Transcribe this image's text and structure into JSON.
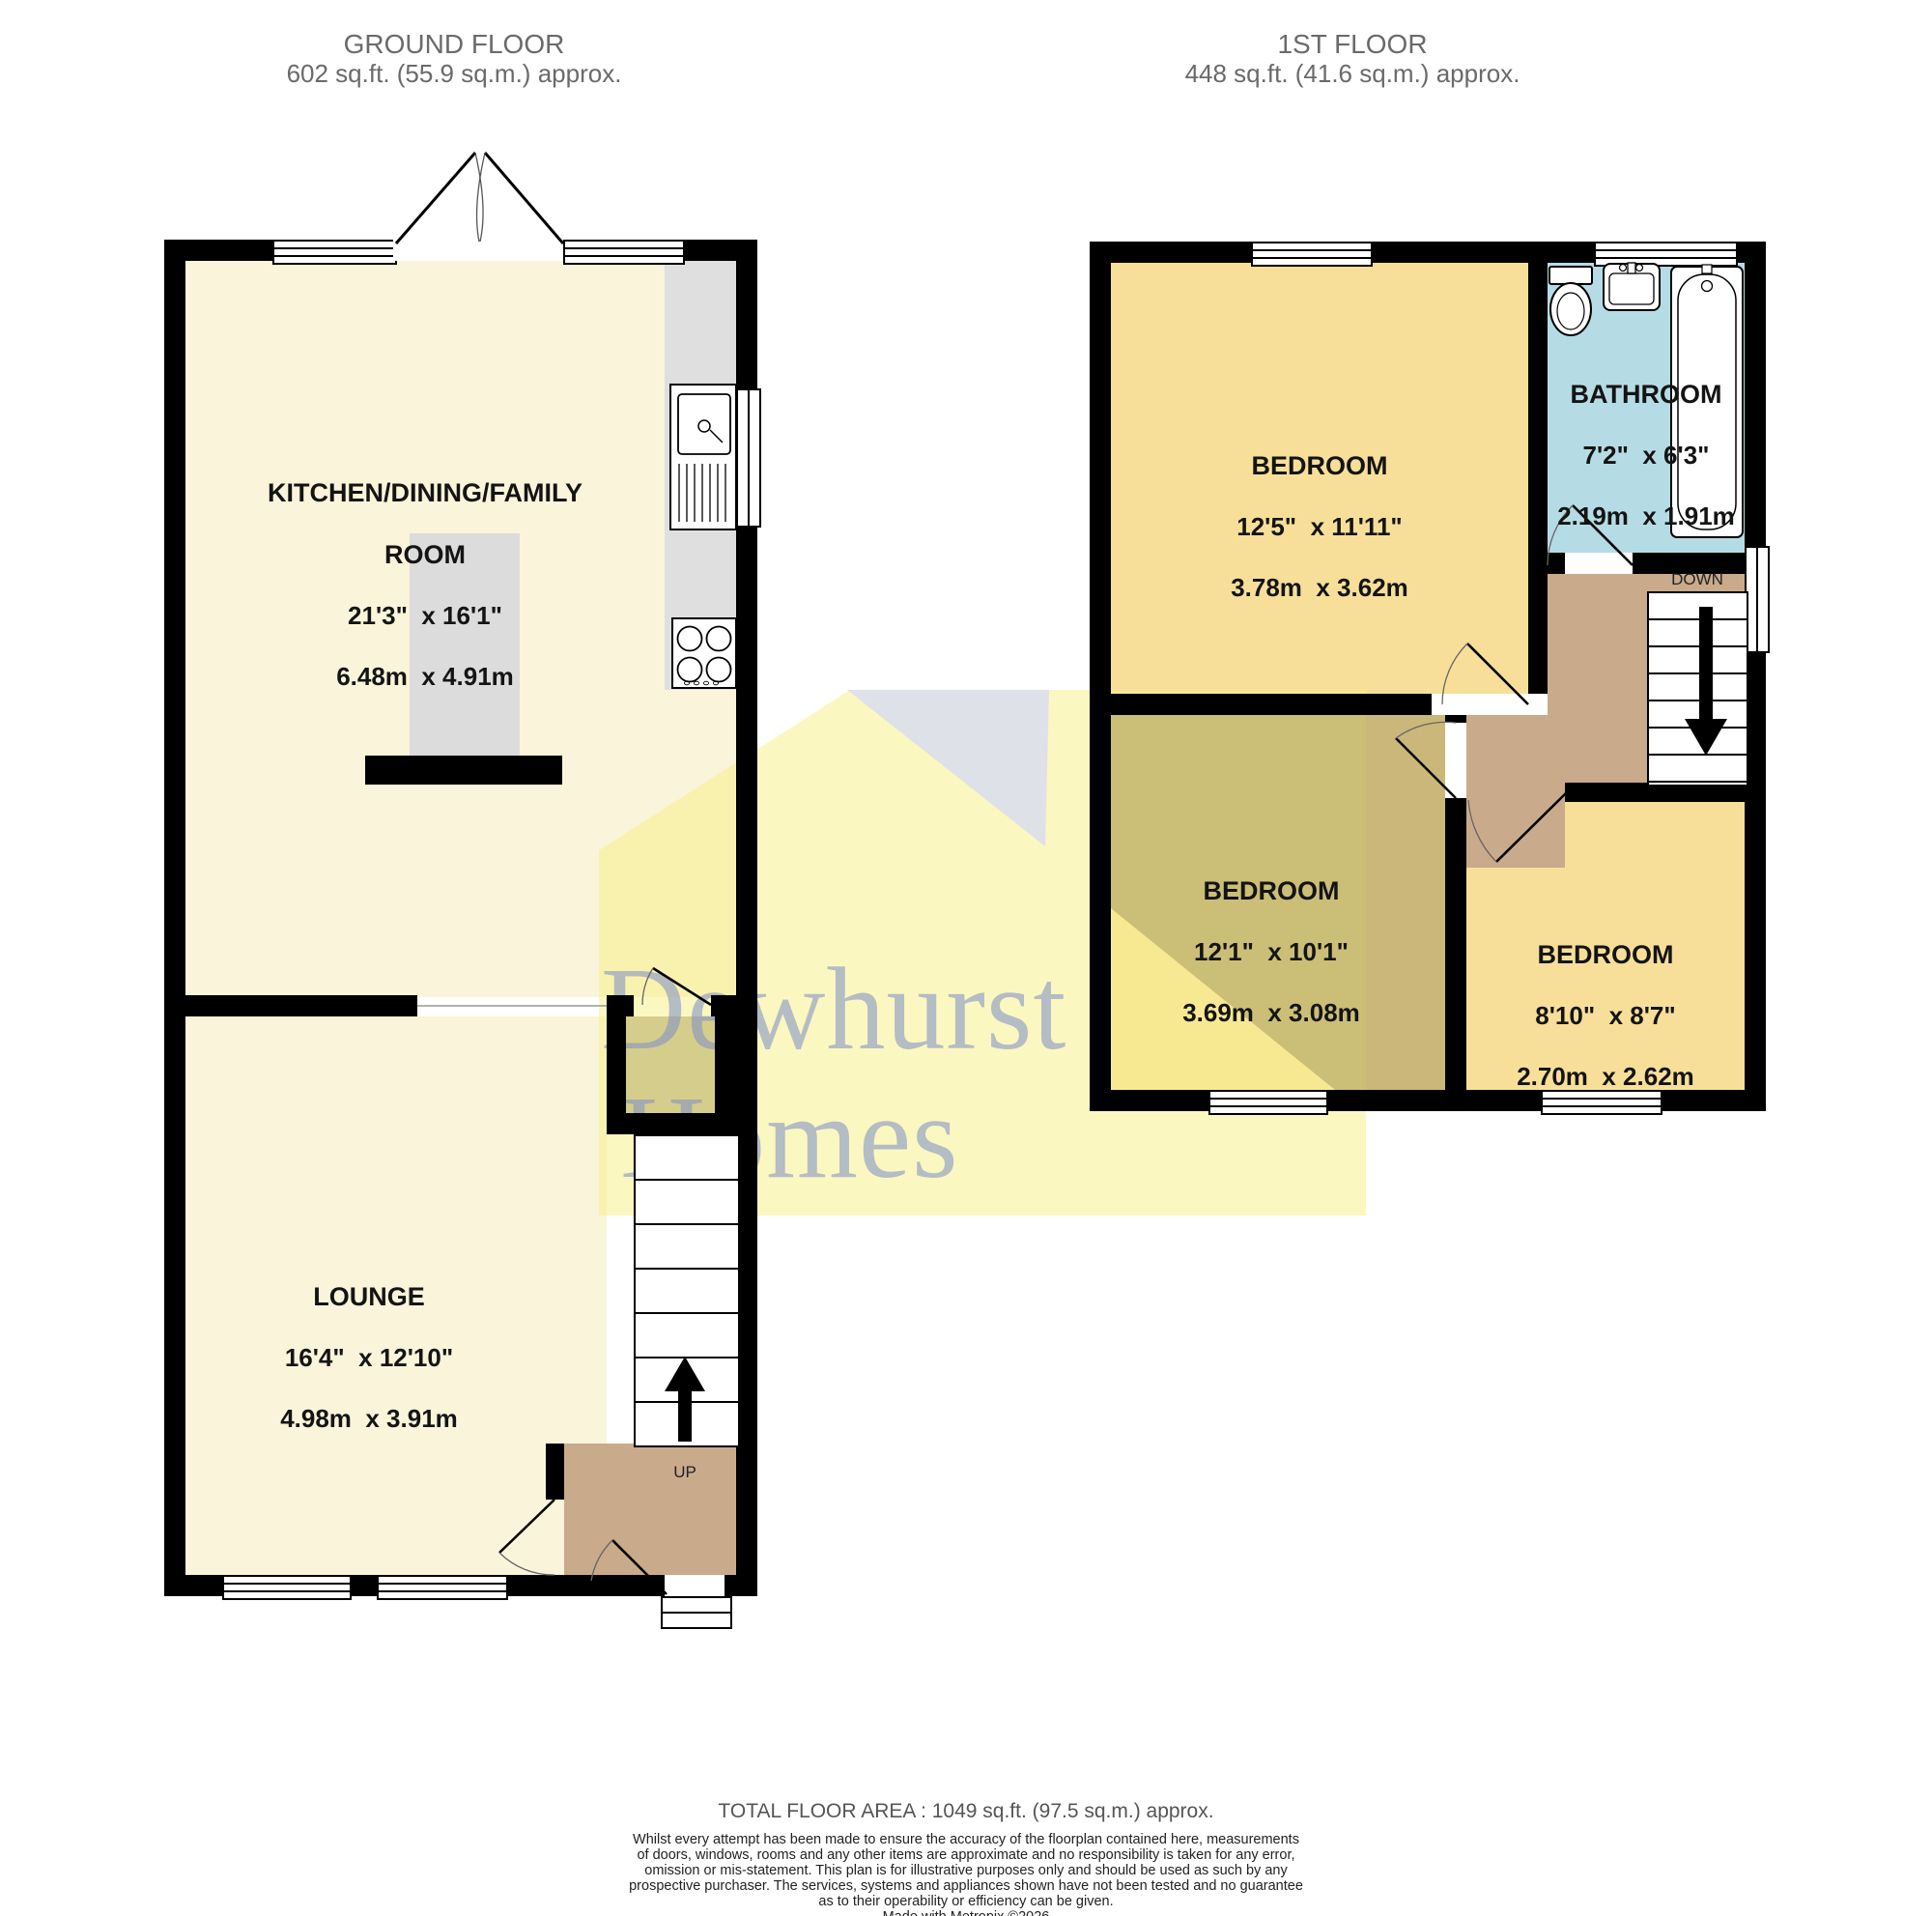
{
  "header": {
    "ground_floor": {
      "title": "GROUND FLOOR",
      "area": "602 sq.ft. (55.9 sq.m.) approx."
    },
    "first_floor": {
      "title": "1ST FLOOR",
      "area": "448 sq.ft. (41.6 sq.m.) approx."
    }
  },
  "rooms": {
    "kitchen": {
      "name": "KITCHEN/DINING/FAMILY",
      "name2": "ROOM",
      "imperial": "21'3\"  x 16'1\"",
      "metric": "6.48m  x 4.91m"
    },
    "lounge": {
      "name": "LOUNGE",
      "imperial": "16'4\"  x 12'10\"",
      "metric": "4.98m  x 3.91m"
    },
    "storage": {
      "name": "STORAGE"
    },
    "bedroom1": {
      "name": "BEDROOM",
      "imperial": "12'5\"  x 11'11\"",
      "metric": "3.78m  x 3.62m"
    },
    "bathroom": {
      "name": "BATHROOM",
      "imperial": "7'2\"  x 6'3\"",
      "metric": "2.19m  x 1.91m"
    },
    "bedroom2": {
      "name": "BEDROOM",
      "imperial": "12'1\"  x 10'1\"",
      "metric": "3.69m  x 3.08m"
    },
    "bedroom3": {
      "name": "BEDROOM",
      "imperial": "8'10\"  x 8'7\"",
      "metric": "2.70m  x 2.62m"
    }
  },
  "stairs": {
    "up": "UP",
    "down": "DOWN"
  },
  "watermark": {
    "line1": "Dewhurst",
    "line2": "Homes"
  },
  "footer": {
    "total": "TOTAL FLOOR AREA : 1049 sq.ft. (97.5 sq.m.) approx.",
    "disclaimer": [
      "Whilst every attempt has been made to ensure the accuracy of the floorplan contained here, measurements",
      "of doors, windows, rooms and any other items are approximate and no responsibility is taken for any error,",
      "omission or mis-statement. This plan is for illustrative purposes only and should be used as such by any",
      "prospective purchaser. The services, systems and appliances shown have not been tested and no guarantee",
      "as to their operability or efficiency can be given."
    ],
    "credit": "Made with Metropix ©2026"
  },
  "colors": {
    "floor_cream": "#faf4da",
    "floor_yellow": "#f7df99",
    "bathroom_blue": "#b5dce4",
    "hall_tan": "#c9aa8b",
    "storage_olive": "#aba289",
    "counter_gray": "#dfdfdf",
    "wall_black": "#000000",
    "watermark_yellow": "#f8f08c",
    "watermark_lavender": "#d8ddef"
  }
}
